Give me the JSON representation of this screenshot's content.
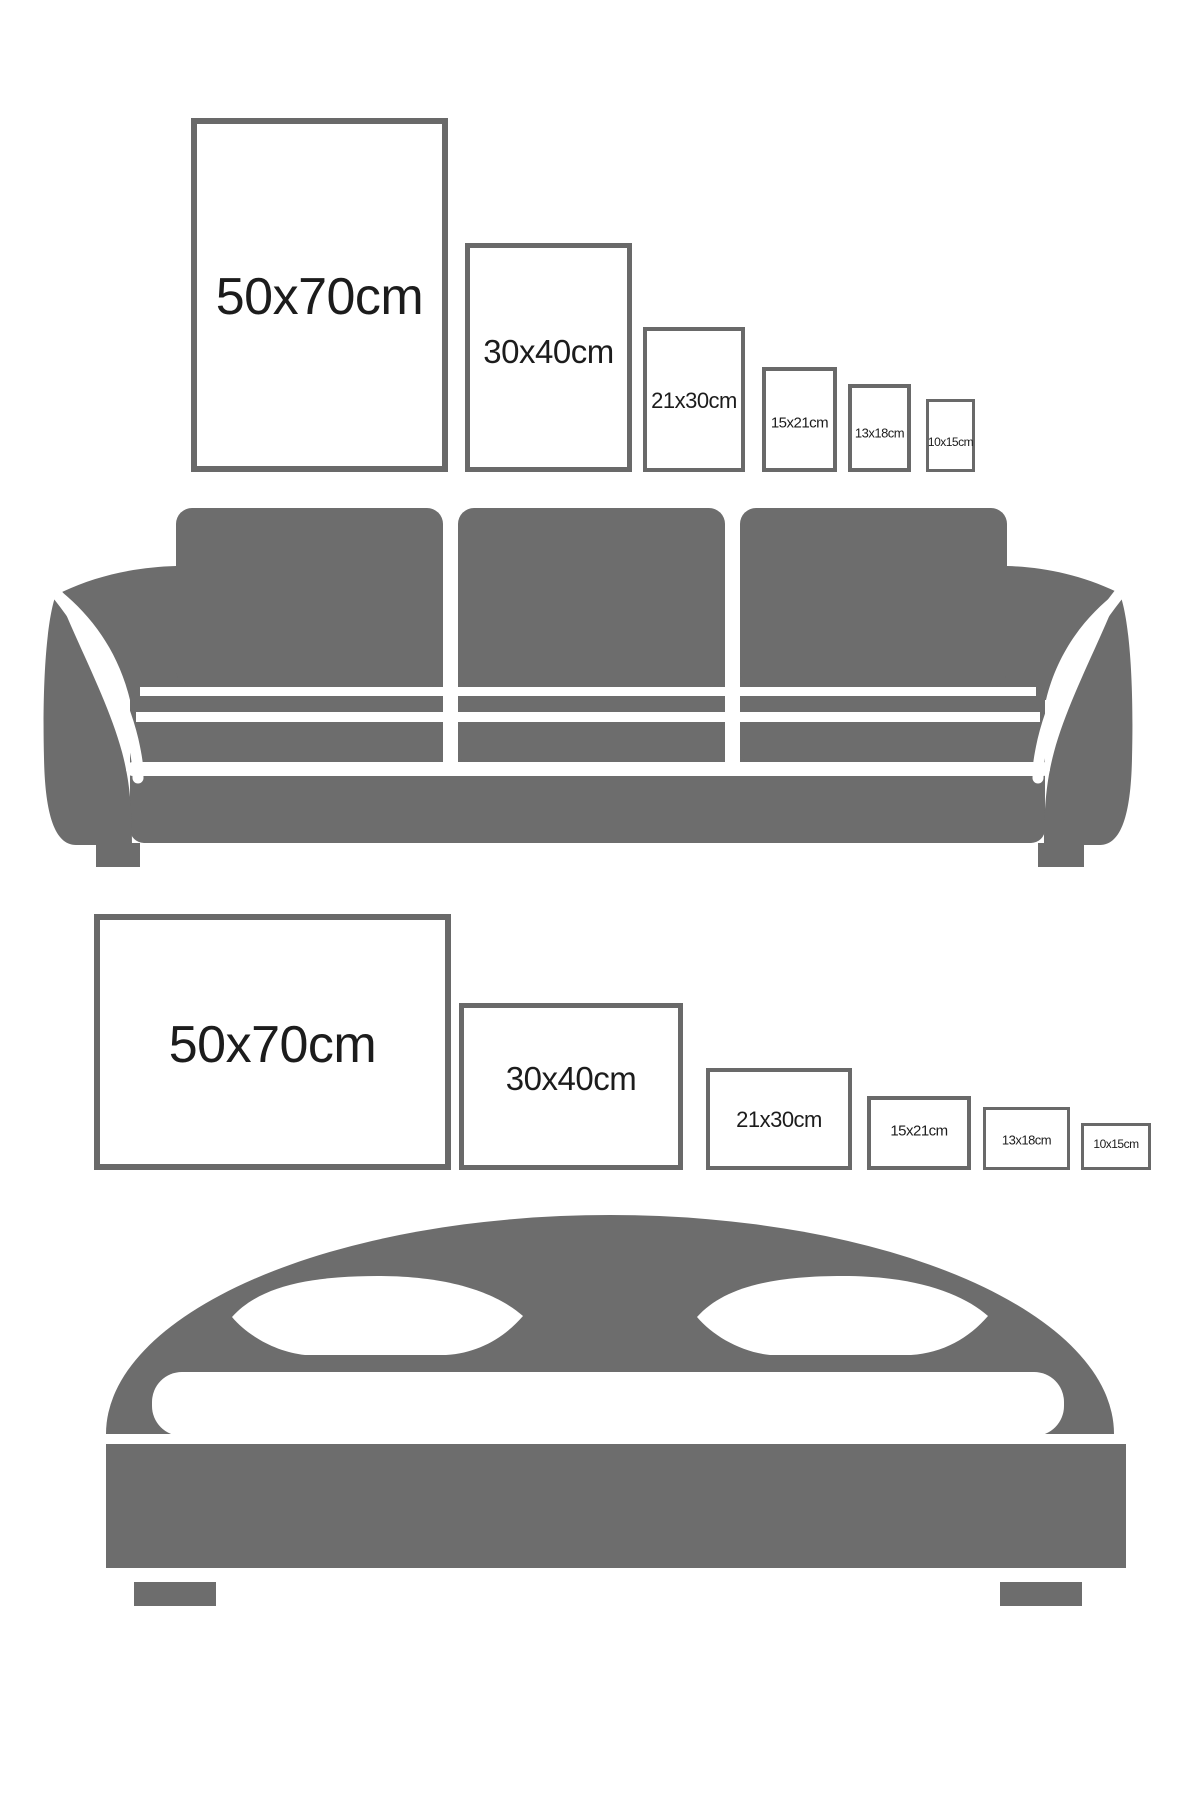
{
  "colors": {
    "background": "#ffffff",
    "furniture_gray": "#6d6d6d",
    "frame_border": "#696969",
    "label_text": "#1c1c1c"
  },
  "icons": [
    "sofa-icon",
    "bed-icon"
  ],
  "sections": [
    {
      "name": "sofa",
      "furniture_icon": "sofa-icon",
      "frame_orientation": "portrait",
      "frames": [
        {
          "label": "50x70cm",
          "x": 191,
          "y": 118,
          "w": 257,
          "h": 354,
          "border": 6,
          "font": 52,
          "label_y": 297
        },
        {
          "label": "30x40cm",
          "x": 465,
          "y": 243,
          "w": 167,
          "h": 229,
          "border": 5,
          "font": 33,
          "label_y": 352
        },
        {
          "label": "21x30cm",
          "x": 643,
          "y": 327,
          "w": 102,
          "h": 145,
          "border": 4,
          "font": 22,
          "label_y": 401
        },
        {
          "label": "15x21cm",
          "x": 762,
          "y": 367,
          "w": 75,
          "h": 105,
          "border": 4,
          "font": 15,
          "label_y": 423
        },
        {
          "label": "13x18cm",
          "x": 848,
          "y": 384,
          "w": 63,
          "h": 88,
          "border": 4,
          "font": 13,
          "label_y": 433
        },
        {
          "label": "10x15cm",
          "x": 926,
          "y": 399,
          "w": 49,
          "h": 73,
          "border": 3,
          "font": 12,
          "label_y": 442
        }
      ]
    },
    {
      "name": "bed",
      "furniture_icon": "bed-icon",
      "frame_orientation": "landscape",
      "frames": [
        {
          "label": "50x70cm",
          "x": 94,
          "y": 914,
          "w": 357,
          "h": 256,
          "border": 6,
          "font": 52,
          "label_y": 1045
        },
        {
          "label": "30x40cm",
          "x": 459,
          "y": 1003,
          "w": 224,
          "h": 167,
          "border": 5,
          "font": 33,
          "label_y": 1079
        },
        {
          "label": "21x30cm",
          "x": 706,
          "y": 1068,
          "w": 146,
          "h": 102,
          "border": 4,
          "font": 22,
          "label_y": 1120
        },
        {
          "label": "15x21cm",
          "x": 867,
          "y": 1096,
          "w": 104,
          "h": 74,
          "border": 4,
          "font": 15,
          "label_y": 1131
        },
        {
          "label": "13x18cm",
          "x": 983,
          "y": 1107,
          "w": 87,
          "h": 63,
          "border": 3,
          "font": 13,
          "label_y": 1140
        },
        {
          "label": "10x15cm",
          "x": 1081,
          "y": 1123,
          "w": 70,
          "h": 47,
          "border": 3,
          "font": 12,
          "label_y": 1144
        }
      ]
    }
  ]
}
